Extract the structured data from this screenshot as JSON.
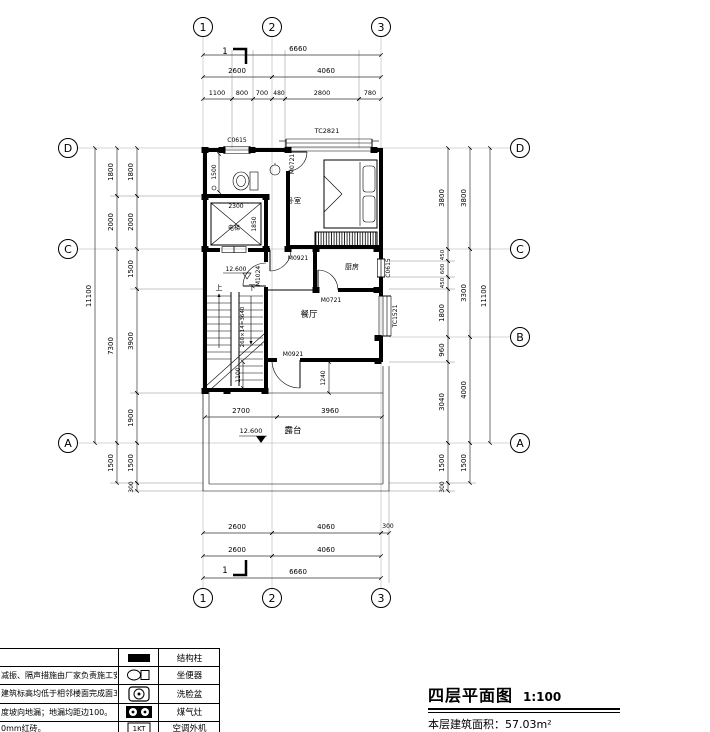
{
  "drawing": {
    "grid_cols": [
      "1",
      "2",
      "3"
    ],
    "grid_rows": {
      "d": "D",
      "c": "C",
      "b": "B",
      "a": "A"
    },
    "dims_top": {
      "overall": "6660",
      "mid": [
        "2600",
        "4060"
      ],
      "detail": [
        "1100",
        "800",
        "700",
        "480",
        "2800",
        "780"
      ]
    },
    "dims_bottom": {
      "row1": [
        "2600",
        "4060",
        "300"
      ],
      "row2": [
        "2600",
        "4060"
      ],
      "overall": "6660"
    },
    "dims_left": {
      "outer": "11100",
      "mid": [
        "1800",
        "2000",
        "7300",
        "1500"
      ],
      "inner": [
        "1800",
        "2000",
        "1500",
        "3900",
        "1900",
        "1500",
        "300"
      ]
    },
    "dims_right": {
      "outer": "11100",
      "mid": [
        "3800",
        "3300",
        "4000",
        "1500"
      ],
      "inner": [
        "3800",
        "450",
        "600",
        "450",
        "1800",
        "960",
        "3040",
        "1500",
        "300"
      ]
    },
    "dims_inner": {
      "elev_w": "2300",
      "elev_d": "1850",
      "bath": "1500",
      "stair": "260×14=3640",
      "landing": "1100",
      "door": "1240",
      "terr_l": "2700",
      "terr_r": "3960"
    },
    "levels": {
      "stair": "12.600",
      "terrace": "12.600"
    },
    "rooms": {
      "elevator": "电梯",
      "bedroom": "卧室",
      "kitchen": "厨房",
      "dining": "餐厅",
      "terrace": "露台",
      "up": "上",
      "down": "下"
    },
    "openings": {
      "c0615_top": "C0615",
      "tc2821": "TC2821",
      "m0721_bed": "M0721",
      "c0615_right": "C0615",
      "m0921_hall": "M0921",
      "m1024": "M1024",
      "m0721_kitchen": "M0721",
      "tc1521": "TC1521",
      "m0921_terrace": "M0921"
    },
    "section_marker": "1"
  },
  "legend": {
    "rows": [
      {
        "note": "",
        "name": "结构柱"
      },
      {
        "note": "减振、隔声措施由厂家负责施工安装；",
        "name": "坐便器"
      },
      {
        "note": "建筑标高均低于相邻楼面完成面30",
        "name": "洗脸盆"
      },
      {
        "note": "度坡向地漏；地漏均距边100。",
        "name": "煤气灶"
      },
      {
        "note": "0mm红砖。",
        "name": "空调外机"
      }
    ],
    "ac_icon_text": "1KT"
  },
  "title_block": {
    "title": "四层平面图",
    "scale": "1:100",
    "area": "本层建筑面积：57.03m²"
  }
}
